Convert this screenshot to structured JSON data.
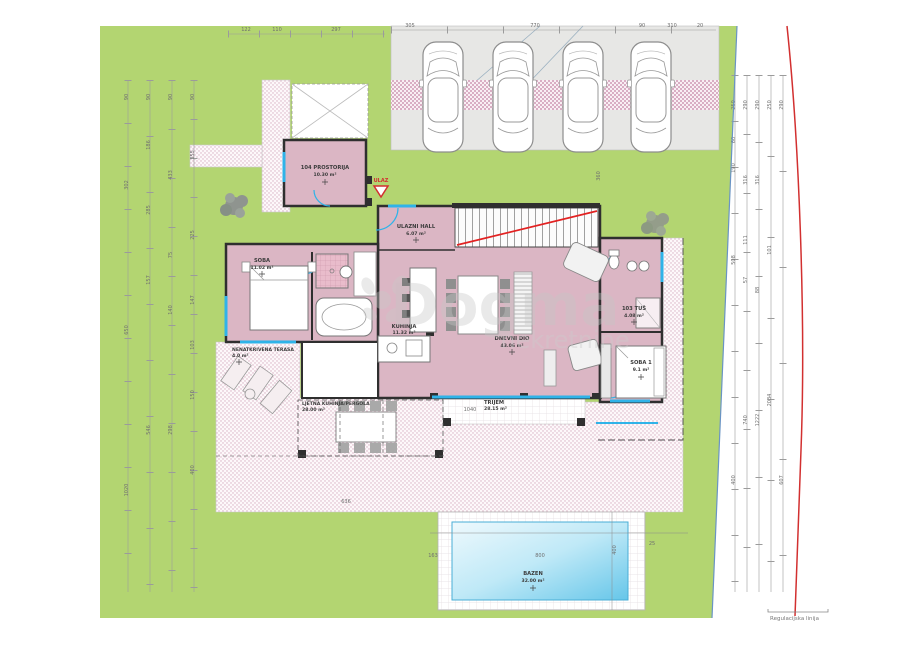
{
  "watermark": {
    "brand": "Dogma",
    "tagline": "nekretnine"
  },
  "entrance": {
    "label": "ULAZ"
  },
  "legend": {
    "boundary_note": "Regulacijska linija"
  },
  "rooms": {
    "prostorija": {
      "name": "104 PROSTORIJA",
      "area": "10.30 m²"
    },
    "hall": {
      "name": "ULAZNI HALL",
      "area": "6.07 m²"
    },
    "soba": {
      "name": "SOBA",
      "area": "11.02 m²"
    },
    "kuhinja": {
      "name": "KUHINJA",
      "area": "11.32 m²"
    },
    "dnevni": {
      "name": "DNEVNI DIO",
      "area": "43.06 m²"
    },
    "tus": {
      "name": "103 TUŠ",
      "area": "4.08 m²"
    },
    "soba1": {
      "name": "SOBA 1",
      "area": "9.1 m²"
    },
    "terasa": {
      "name": "NENATKRIVENA TERASA",
      "area": "4.0 m²"
    },
    "pergola": {
      "name": "LJETNA KUHINJA/PERGOLA",
      "area": "28.00 m²"
    },
    "trijem": {
      "name": "TRIJEM",
      "area": "28.15 m²"
    },
    "bazen": {
      "name": "BAZEN",
      "area": "32.00 m²"
    }
  },
  "dims": {
    "top_lawn": [
      "122",
      "110",
      "297"
    ],
    "top_parking": [
      "305",
      "770",
      "90",
      "310",
      "20"
    ],
    "left1": [
      "90",
      "302",
      "650",
      "1020"
    ],
    "left2": [
      "90",
      "186",
      "285",
      "157",
      "546"
    ],
    "left3": [
      "90",
      "433",
      "75",
      "140",
      "298"
    ],
    "left4": [
      "90",
      "355",
      "225",
      "147",
      "103",
      "150",
      "400"
    ],
    "right1": [
      "250",
      "60",
      "190",
      "508",
      "400"
    ],
    "right2": [
      "290",
      "316",
      "111",
      "57",
      "740"
    ],
    "right3": [
      "290",
      "316",
      "88",
      "1222"
    ],
    "right4": [
      "250",
      "101",
      "2034"
    ],
    "right5": [
      "290",
      "607"
    ],
    "pool": {
      "w": "800",
      "h": "400",
      "offset": "163",
      "edge": "25"
    },
    "below_parking": "360",
    "trijem_width": "1040",
    "pergola_width": "636"
  },
  "colors": {
    "lawn": "#b3d571",
    "room_pink": "#dbb6c4",
    "pool_blue": "#6cc9ea",
    "wall": "#2f2f2f",
    "accent_cyan": "#2fb3e8",
    "boundary_red": "#d23030",
    "boundary_blue": "#6a94c4"
  }
}
